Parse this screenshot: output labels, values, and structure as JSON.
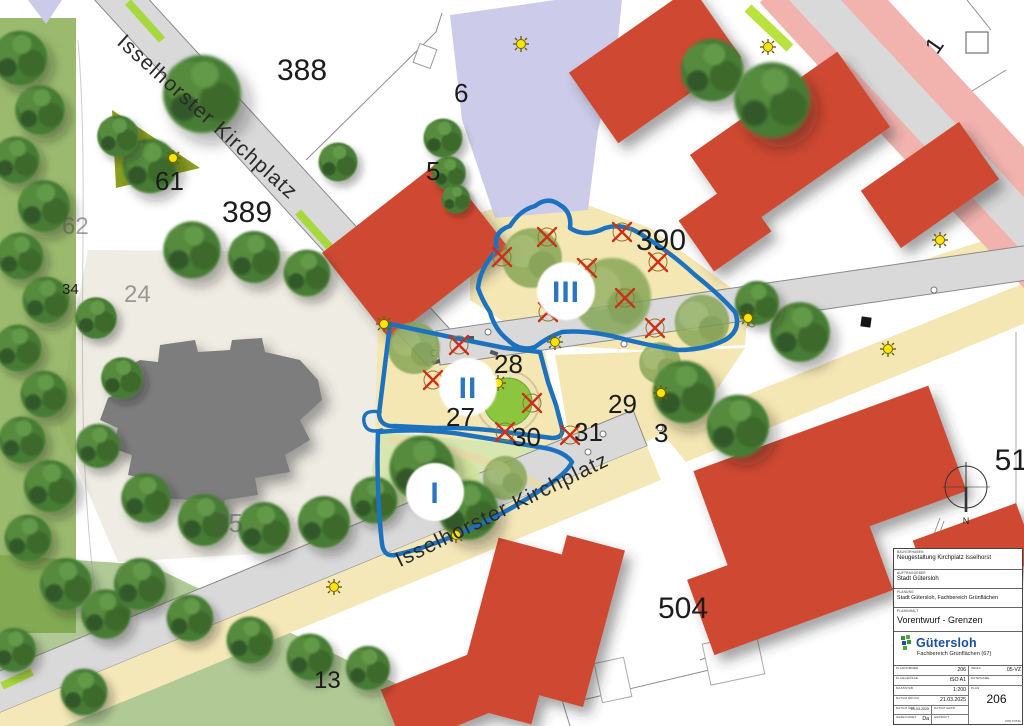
{
  "map": {
    "street_label_1": "Isselhorster Kirchplatz",
    "street_label_2": "Isselhorster Kirchplatz",
    "parcels": {
      "p388": "388",
      "p389": "389",
      "p390": "390",
      "p61": "61",
      "p62": "62",
      "p34": "34",
      "p24": "24",
      "p25": "25",
      "p5": "5",
      "p6": "6",
      "p27": "27",
      "p28": "28",
      "p29": "29",
      "p30": "30",
      "p31": "31",
      "p3": "3",
      "p13": "13",
      "p504": "504",
      "p51": "51",
      "p1": "1"
    },
    "regions": {
      "I": "I",
      "II": "II",
      "III": "III"
    },
    "compass_n": "N",
    "colors": {
      "building_red": "#cf4a31",
      "church_gray": "#7d7d7d",
      "playground_beige": "#f4e7b3",
      "road_gray": "#d9d9d9",
      "parcel_lavender": "#cbcbe9",
      "road_pink": "#f2b2ae",
      "green_olive": "#8a9e1f",
      "strip_lime": "#a7d83d",
      "tree_green": "#4a7c36",
      "region_boundary_blue": "#1d72bf",
      "lamp_yellow": "#ffe400",
      "tree_removal_red": "#cc3018"
    }
  },
  "title_block": {
    "rows": [
      {
        "label": "BAUVORHABEN",
        "value": "Neugestaltung Kirchplatz Isselhorst"
      },
      {
        "label": "AUFTRAGGEBER",
        "value": "Stadt Gütersloh"
      },
      {
        "label": "PLANUNG",
        "value": "Stadt Gütersloh, Fachbereich Grünflächen"
      },
      {
        "label": "PLANINHALT",
        "value": "Vorentwurf - Grenzen"
      }
    ],
    "logo": {
      "name": "Gütersloh",
      "subtitle": "Fachbereich Grünflächen (67)"
    },
    "fields": {
      "plannummer_label": "PLANNUMMER",
      "plannummer": "206",
      "index_label": "INDEX",
      "index": "05-VZ",
      "plangroesse_label": "PLANGRÖSSE",
      "plangroesse": "ISO A1",
      "dateiname_label": "DATEINAME",
      "dateiname": "",
      "massstab_label": "MASSSTAB",
      "massstab": "1:200",
      "plan_label": "PLAN",
      "plan": "206",
      "datum_druck_label": "DATUM DRUCK",
      "datum_druck": "21.03.2025",
      "datum_gez_label": "DATUM GEZ.",
      "datum_gez": "21.03.2025",
      "datum_gepr_label": "DATUM GEPR.",
      "datum_gepr": "",
      "gezeichnet_label": "GEZEICHNET",
      "gezeichnet": "Da",
      "geprueft_label": "GEPRÜFT",
      "geprueft": "",
      "von_total_label": "VON TOTAL"
    }
  }
}
